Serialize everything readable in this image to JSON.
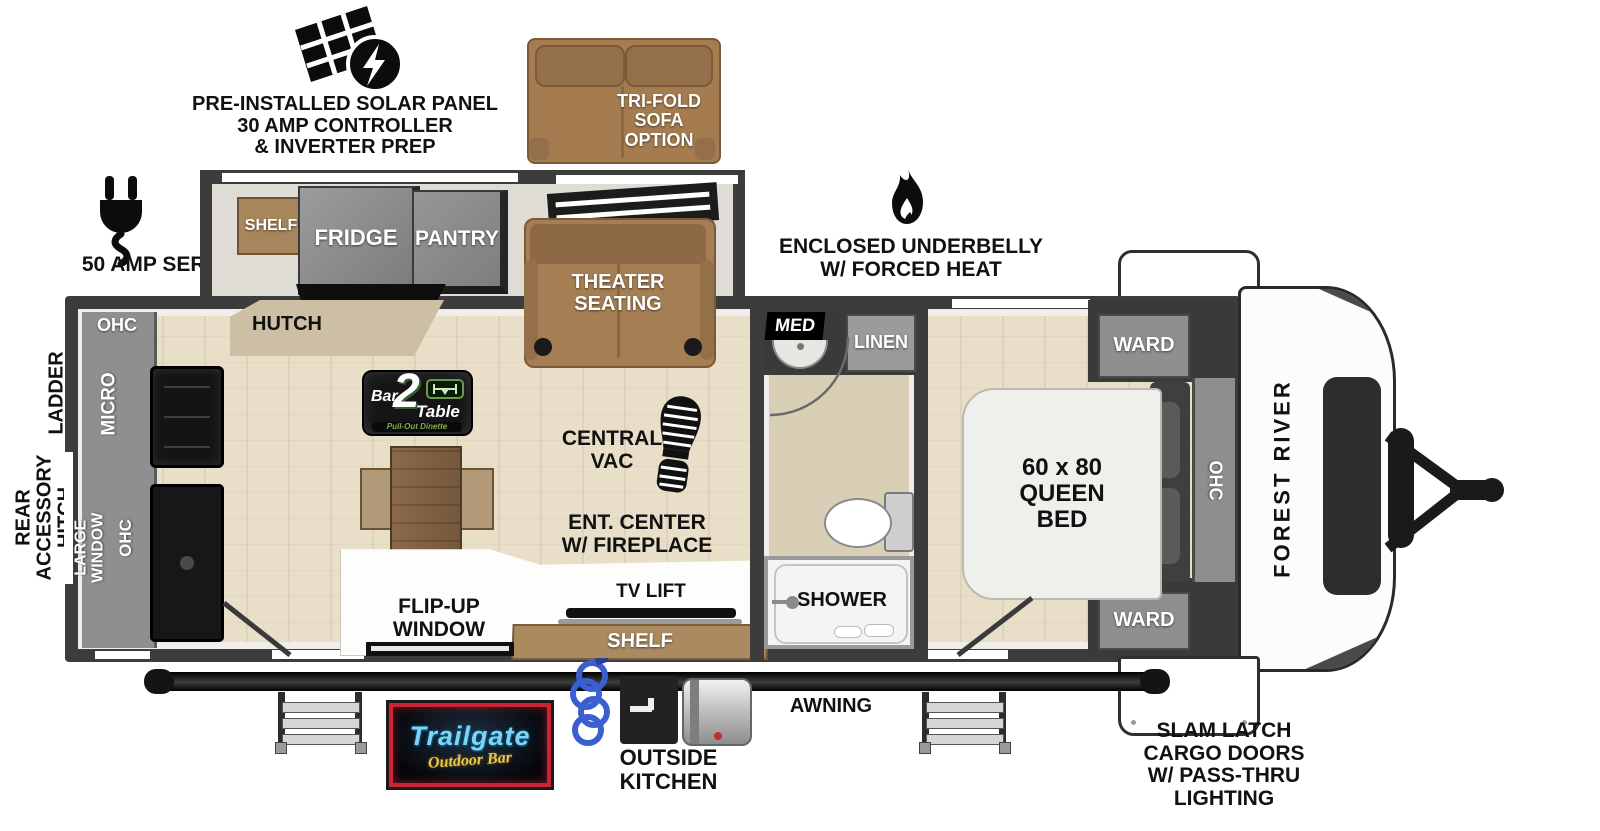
{
  "callouts": {
    "solar": "PRE-INSTALLED SOLAR PANEL\n30 AMP CONTROLLER\n& INVERTER PREP",
    "amp_service": "50 AMP SERVICE",
    "ladder_prep": "LADDER\nPREP",
    "rear_accessory_hitch": "REAR\nACCESSORY\nHITCH",
    "underbelly": "ENCLOSED UNDERBELLY\nW/ FORCED HEAT",
    "awning": "AWNING",
    "outside_kitchen": "OUTSIDE\nKITCHEN",
    "cargo_doors": "SLAM LATCH\nCARGO DOORS\nW/ PASS-THRU\nLIGHTING",
    "trifold_sofa": "TRI-FOLD\nSOFA\nOPTION"
  },
  "kitchen": {
    "ohc_top": "OHC",
    "micro": "MICRO",
    "large_window": "LARGE WINDOW",
    "ohc_side": "OHC",
    "shelf": "SHELF",
    "fridge": "FRIDGE",
    "pantry": "PANTRY",
    "hutch": "HUTCH"
  },
  "living": {
    "theater_seating": "THEATER\nSEATING",
    "central_vac": "CENTRAL\nVAC",
    "ent_center": "ENT. CENTER\nW/ FIREPLACE",
    "tv_lift": "TV LIFT",
    "shelf": "SHELF",
    "flip_up_window": "FLIP-UP\nWINDOW"
  },
  "bathroom": {
    "med": "MED",
    "linen": "LINEN",
    "shower": "SHOWER"
  },
  "bedroom": {
    "ward_top": "WARD",
    "ward_bottom": "WARD",
    "bed": "60 x 80\nQUEEN\nBED",
    "ohc": "OHC"
  },
  "logos": {
    "bar2table": {
      "bar": "Bar",
      "num": "2",
      "table": "Table",
      "tagline": "Pull-Out Dinette"
    },
    "trailgate": {
      "name": "Trailgate",
      "tagline": "Outdoor Bar"
    },
    "brand": "FOREST RIVER"
  },
  "colors": {
    "wall": "#3c3c3c",
    "floor": "#e9dfc9",
    "cabinet_gray": "#8f8f8f",
    "furniture_brown": "#a57e54",
    "trailgate_red": "#cc2233",
    "trailgate_blue": "#7fd4f5",
    "trailgate_yellow": "#e8c84a",
    "bar2table_green": "#7fb048"
  }
}
